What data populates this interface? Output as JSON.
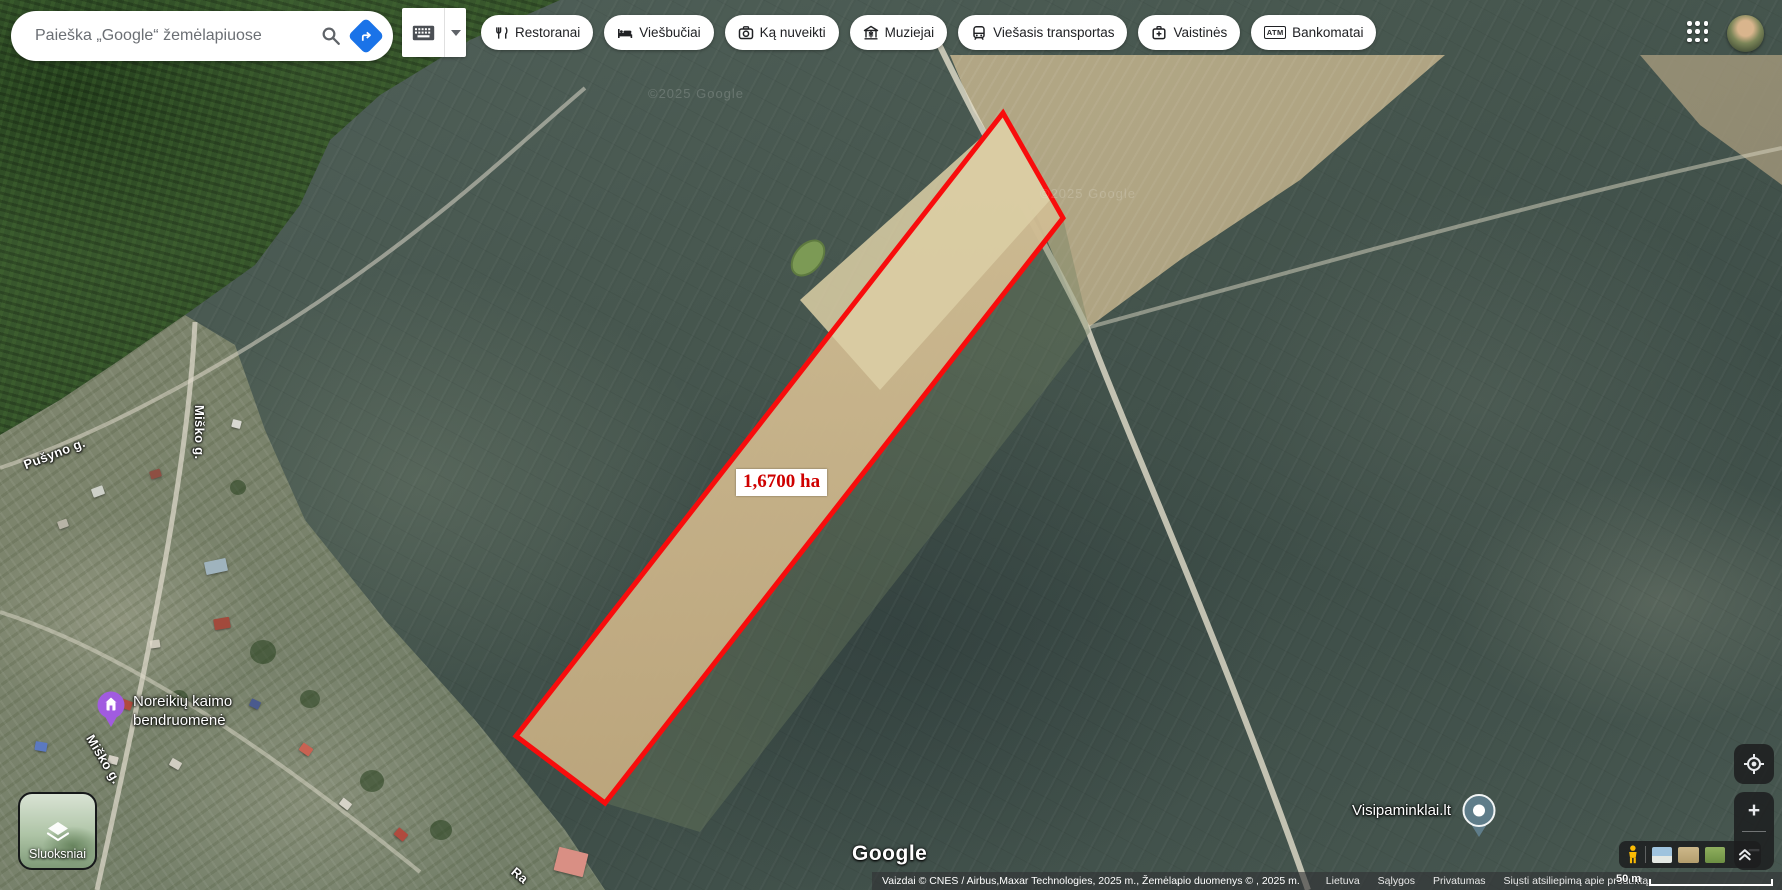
{
  "topbar": {
    "search_placeholder": "Paieška „Google“ žemėlapiuose"
  },
  "chips": [
    {
      "label": "Restoranai"
    },
    {
      "label": "Viešbučiai"
    },
    {
      "label": "Ką nuveikti"
    },
    {
      "label": "Muziejai"
    },
    {
      "label": "Viešasis transportas"
    },
    {
      "label": "Vaistinės"
    },
    {
      "label": "Bankomatai"
    }
  ],
  "atm_icon_text": "ATM",
  "map": {
    "street_labels": {
      "pusyno": "Pušyno g.",
      "misko_vertical": "Miško g.",
      "misko_diagonal": "Miško g.",
      "partial_bottom": "Ra"
    },
    "poi": {
      "noreikiu_line1": "Noreikių kaimo",
      "noreikiu_line2": "bendruomenė",
      "visipaminklai": "Visipaminklai.lt"
    },
    "watermark": "©2025 Google",
    "parcel_area": "1,6700 ha"
  },
  "layers_button": {
    "label": "Sluoksniai"
  },
  "google_logo": "Google",
  "zoom_controls": {
    "zoom_in": "+",
    "zoom_out": "−"
  },
  "footer": {
    "attribution": "Vaizdai © CNES / Airbus,Maxar Technologies, 2025 m., Žemėlapio duomenys © , 2025 m.",
    "links": [
      {
        "label": "Lietuva"
      },
      {
        "label": "Sąlygos"
      },
      {
        "label": "Privatumas"
      },
      {
        "label": "Siųsti atsiliepimą apie produktą"
      }
    ],
    "scale": "50 m"
  },
  "colors": {
    "accent_blue": "#1a73e8",
    "parcel_outline": "#f80c0c",
    "area_text": "#cf0000",
    "poi_purple": "#a15be0",
    "pin_teal": "#5f7d8a"
  }
}
